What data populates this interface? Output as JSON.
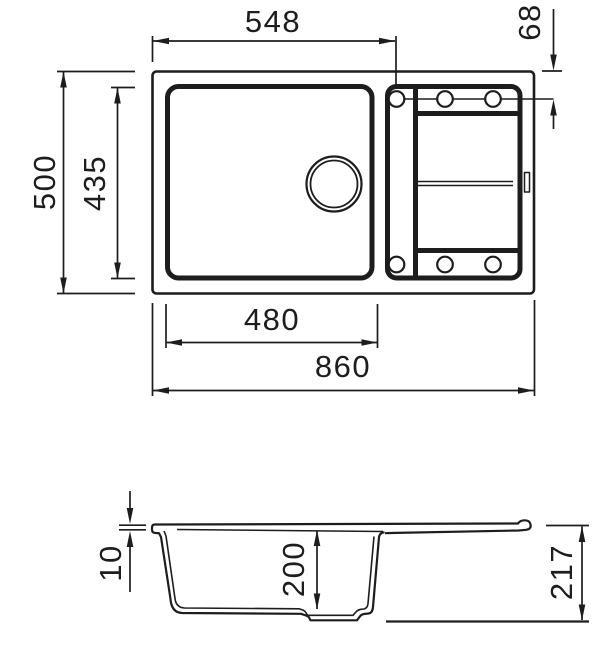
{
  "drawing": {
    "subject": "Kitchen sink with drainboard - dimensioned technical drawing (top view and side section view)",
    "views": [
      {
        "name": "top-view"
      },
      {
        "name": "side-section-view"
      }
    ],
    "colors": {
      "line": "#1d1d1d",
      "background": "#ffffff"
    }
  },
  "dims": {
    "top_width_548": "548",
    "hole_offset_68": "68",
    "depth_500": "500",
    "bowl_depth_435": "435",
    "bowl_width_480": "480",
    "total_width_860": "860",
    "rim_10": "10",
    "bowl_inner_depth_200": "200",
    "total_height_217": "217"
  }
}
